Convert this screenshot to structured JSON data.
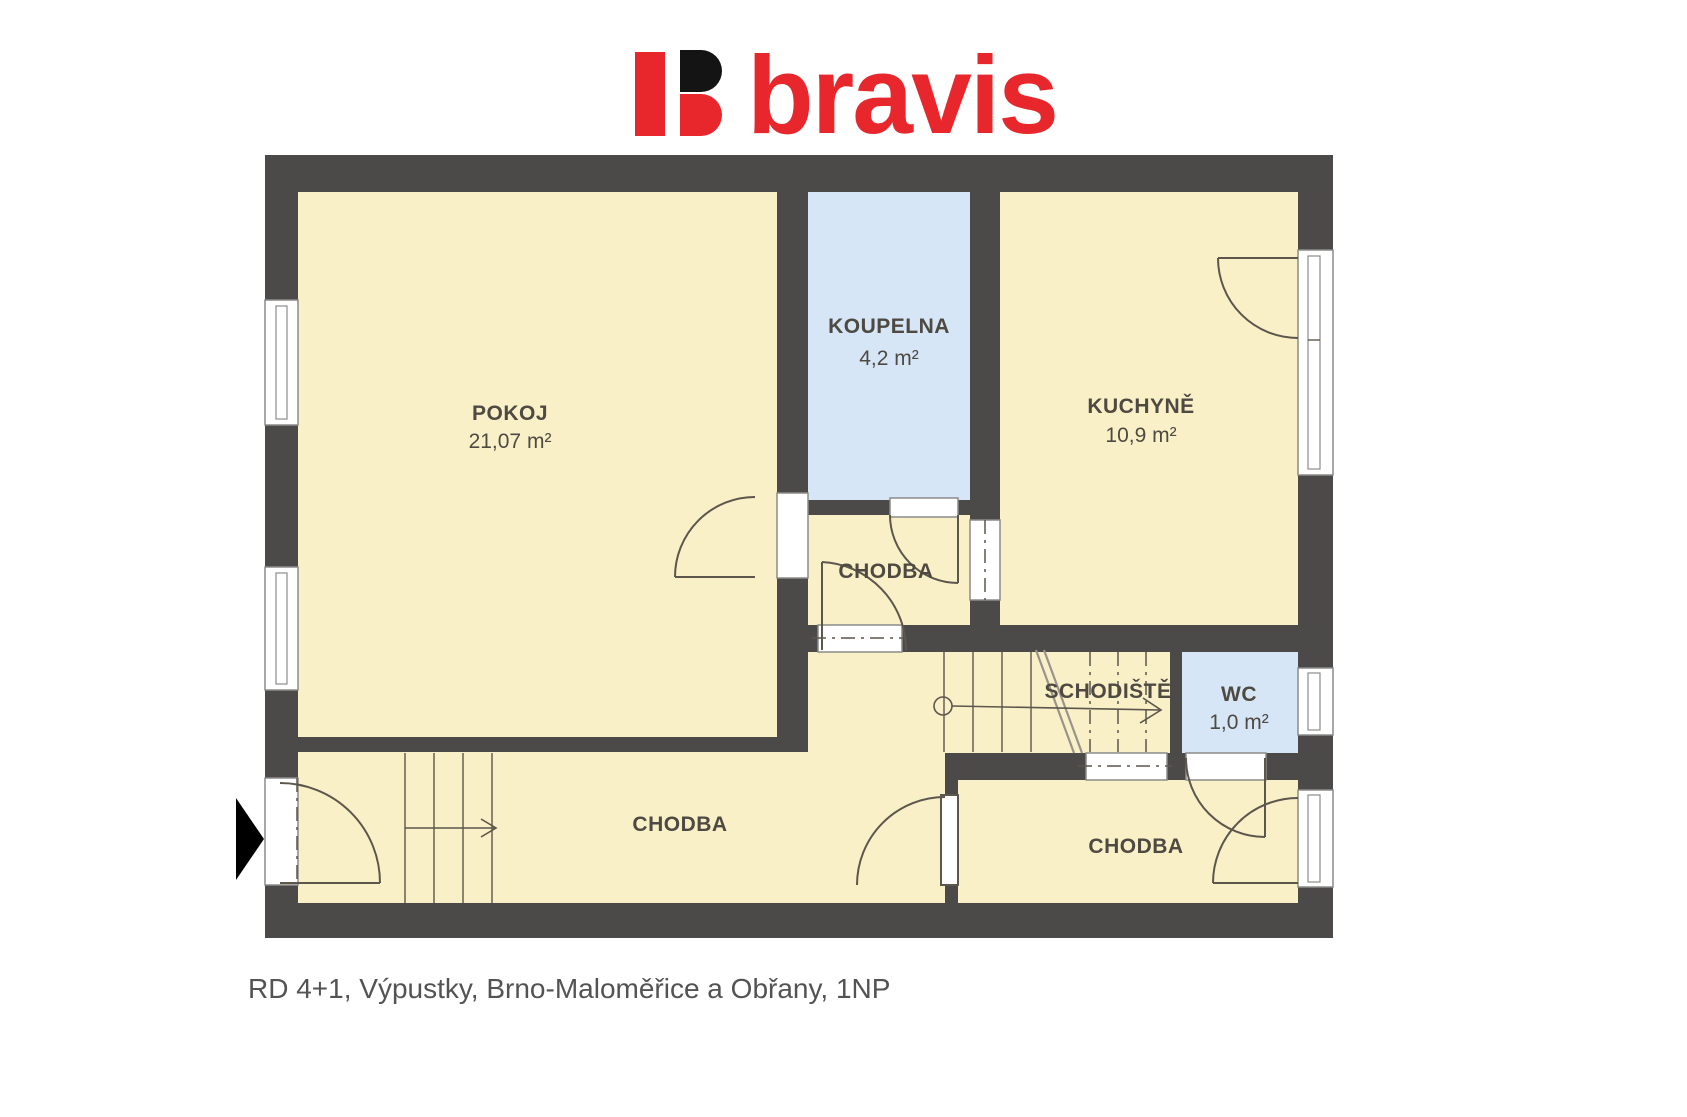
{
  "logo": {
    "name": "bravis",
    "brand_red": "#e8272c",
    "brand_black": "#141414"
  },
  "caption": "RD 4+1, Výpustky, Brno-Maloměřice a Obřany, 1NP",
  "rooms": {
    "pokoj": {
      "label": "POKOJ",
      "area": "21,07 m²"
    },
    "koupelna": {
      "label": "KOUPELNA",
      "area": "4,2 m²"
    },
    "kuchyne": {
      "label": "KUCHYNĚ",
      "area": "10,9 m²"
    },
    "chodba_stred": {
      "label": "CHODBA"
    },
    "schodiste": {
      "label": "SCHODIŠTĚ"
    },
    "wc": {
      "label": "WC",
      "area": "1,0 m²"
    },
    "chodba_dolni": {
      "label": "CHODBA"
    },
    "chodba_prava": {
      "label": "CHODBA"
    }
  },
  "colors": {
    "wall": "#4b4a48",
    "room_fill": "#faf0c8",
    "wet_room_fill": "#d6e6f7",
    "label_text": "#4e4a42",
    "caption_text": "#535353"
  }
}
